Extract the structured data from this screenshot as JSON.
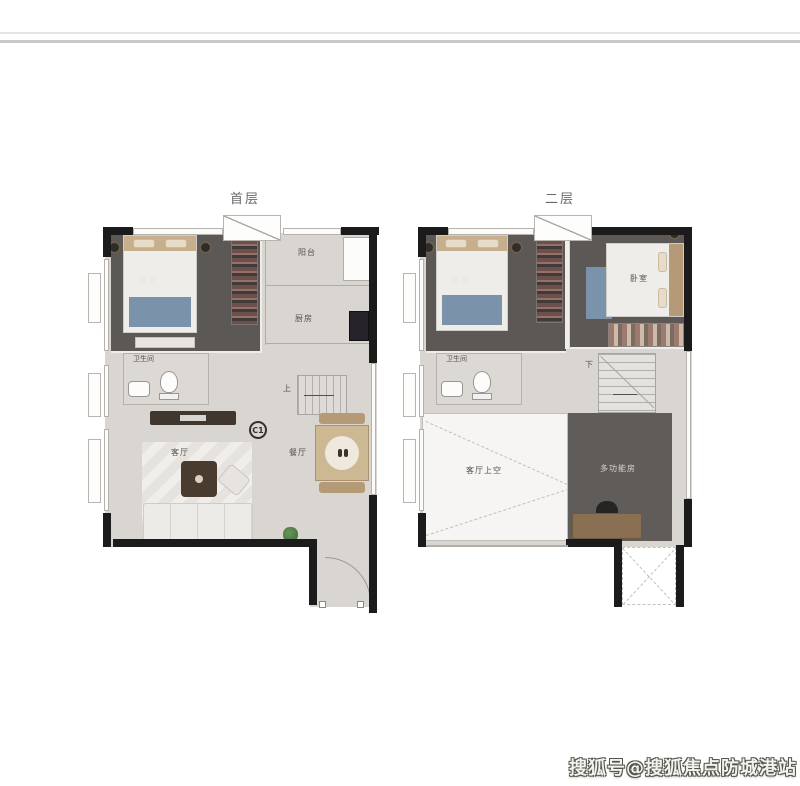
{
  "frame": {
    "watermark": "搜狐号@搜狐焦点防城港站"
  },
  "colors": {
    "wall": "#1b1b1b",
    "floor_light": "#d9d6d1",
    "floor_dark": "#5c5855",
    "accent_blue": "#7b93aa",
    "wood": "#b59a77",
    "title_text": "#6a6a6a"
  },
  "plans": [
    {
      "title": "首层",
      "unit": "C1",
      "labels": {
        "bedroom": "卧室",
        "balcony": "阳台",
        "kitchen": "厨房",
        "bathroom": "卫生间",
        "living": "客厅",
        "dining": "餐厅",
        "stairs": "上"
      }
    },
    {
      "title": "二层",
      "labels": {
        "bedroom1": "卧室",
        "bedroom2": "卧室",
        "bathroom": "卫生间",
        "stairs": "下",
        "living_void": "客厅上空",
        "multi": "多功能房"
      }
    }
  ]
}
